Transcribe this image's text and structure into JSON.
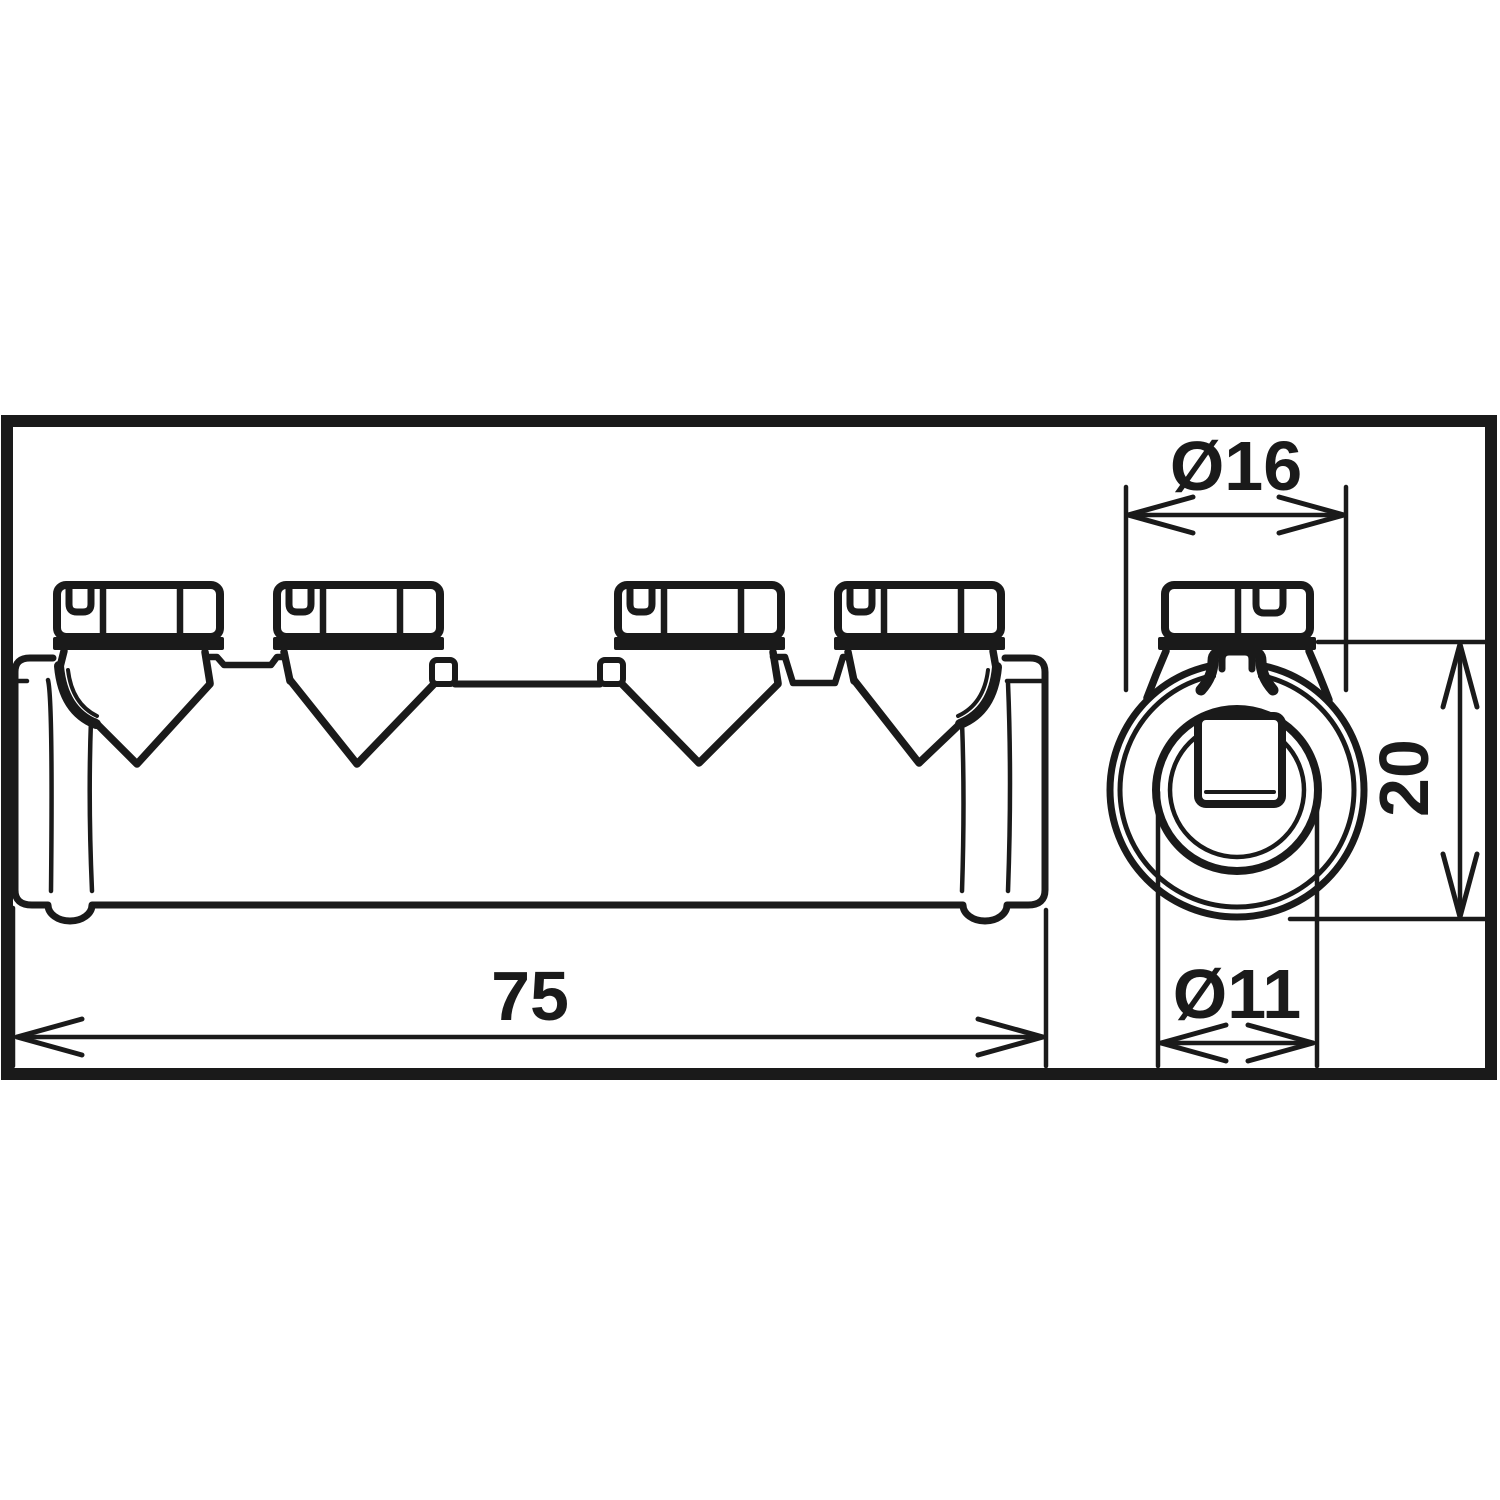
{
  "drawing": {
    "kind": "technical-dimension-drawing",
    "part": "multi-terminal-screw-connector",
    "colors": {
      "ink": "#1a1a1a",
      "background": "#ffffff"
    },
    "side_view": {
      "name": "side-view",
      "screw_count": 4
    },
    "end_view": {
      "name": "end-view"
    },
    "dimensions": {
      "length": {
        "value": "75"
      },
      "outer_diameter": {
        "value": "Ø16"
      },
      "height": {
        "value": "20"
      },
      "bore_diameter": {
        "value": "Ø11"
      }
    }
  }
}
